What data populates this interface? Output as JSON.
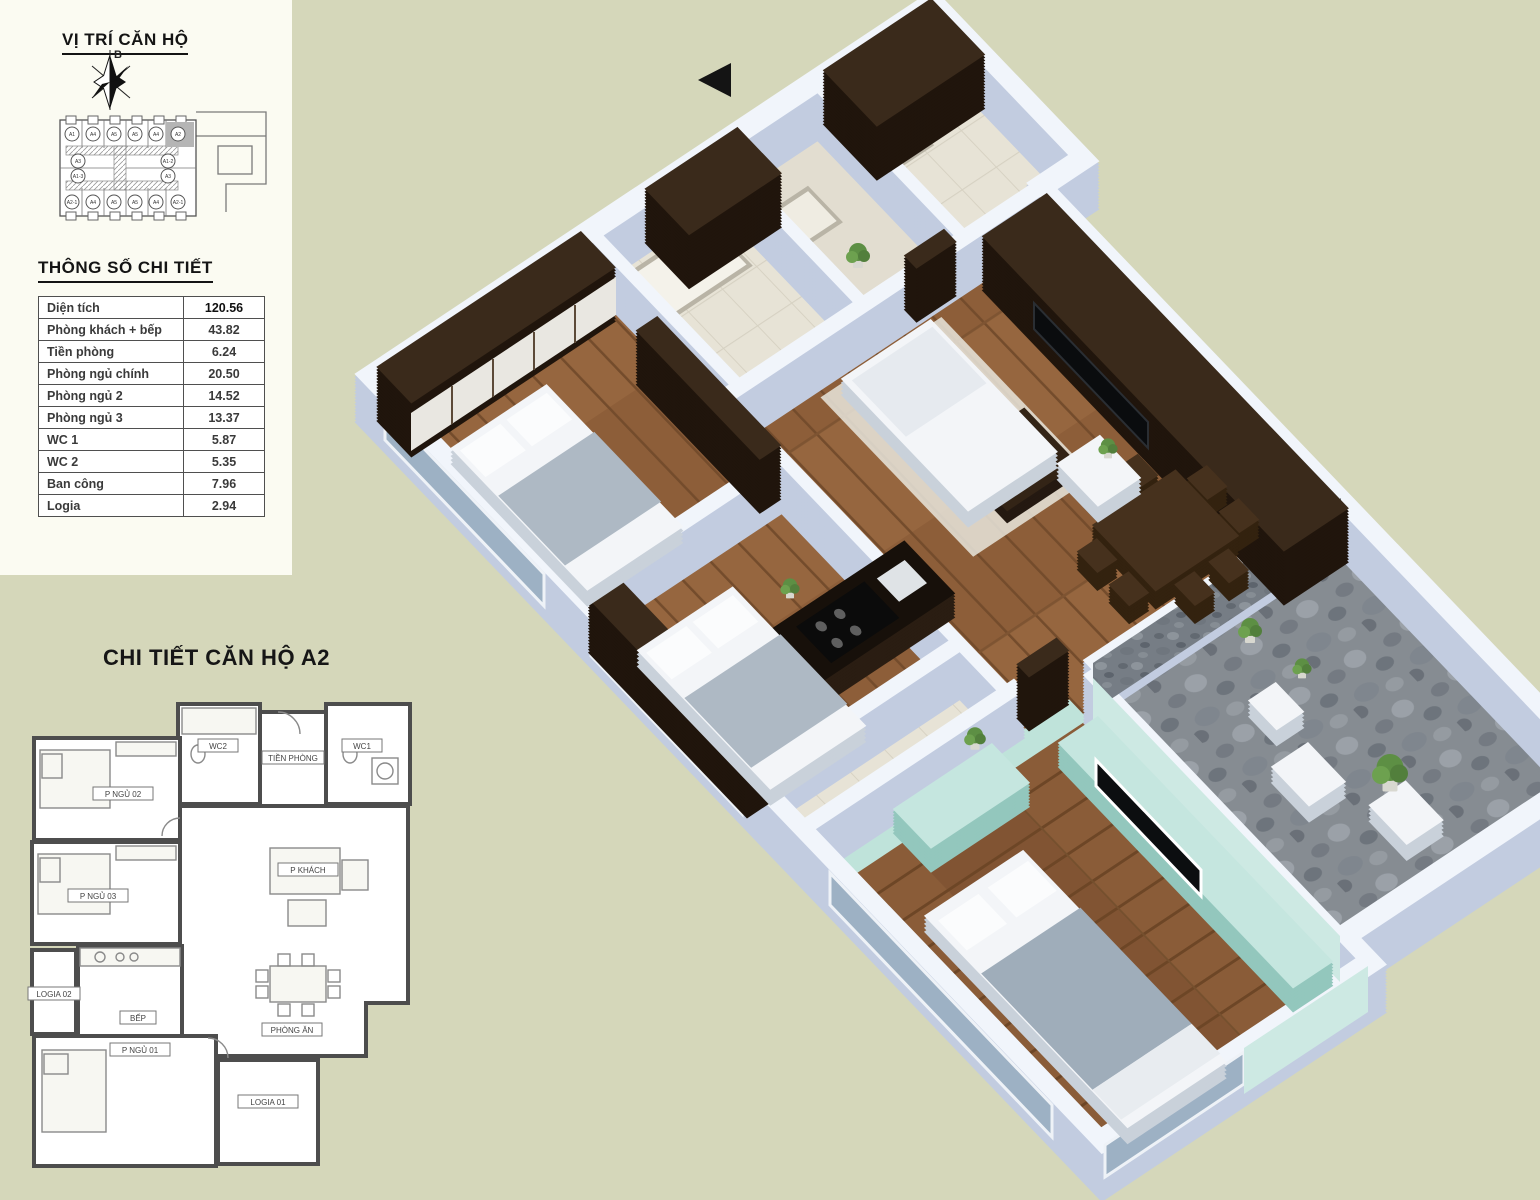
{
  "page": {
    "background_color": "#d5d7ba",
    "accent_mint": "#bfe3da",
    "wood_color": "#96663f",
    "stone_color": "#7c8289"
  },
  "location_panel": {
    "title": "VỊ TRÍ CĂN HỘ",
    "compass_label": "B",
    "highlighted_unit": "A2",
    "units_top": [
      "A1",
      "A4",
      "A5",
      "A5",
      "A4",
      "A2"
    ],
    "units_middle": [
      "A3",
      "A1-2",
      "A1-3",
      "A3"
    ],
    "units_bottom": [
      "A2-1",
      "A4",
      "A5",
      "A5",
      "A4",
      "A2-1"
    ]
  },
  "specs_panel": {
    "title": "THÔNG SỐ CHI TIẾT",
    "rows": [
      {
        "label": "Diện tích",
        "value": "120.56"
      },
      {
        "label": "Phòng khách + bếp",
        "value": "43.82"
      },
      {
        "label": "Tiền phòng",
        "value": "6.24"
      },
      {
        "label": "Phòng ngủ chính",
        "value": "20.50"
      },
      {
        "label": "Phòng ngủ 2",
        "value": "14.52"
      },
      {
        "label": "Phòng ngủ 3",
        "value": "13.37"
      },
      {
        "label": "WC 1",
        "value": "5.87"
      },
      {
        "label": "WC 2",
        "value": "5.35"
      },
      {
        "label": "Ban công",
        "value": "7.96"
      },
      {
        "label": "Logia",
        "value": "2.94"
      }
    ]
  },
  "detail_panel": {
    "title": "CHI TIẾT CĂN HỘ A2",
    "rooms": [
      "P NGỦ 02",
      "WC2",
      "TIỀN PHÒNG",
      "WC1",
      "P NGỦ 03",
      "P KHÁCH",
      "PHÒNG ĂN",
      "BẾP",
      "LOGIA 02",
      "P NGỦ 01",
      "LOGIA 01"
    ]
  },
  "render3d": {
    "name": "3d-isometric-render-apartment-A2"
  }
}
